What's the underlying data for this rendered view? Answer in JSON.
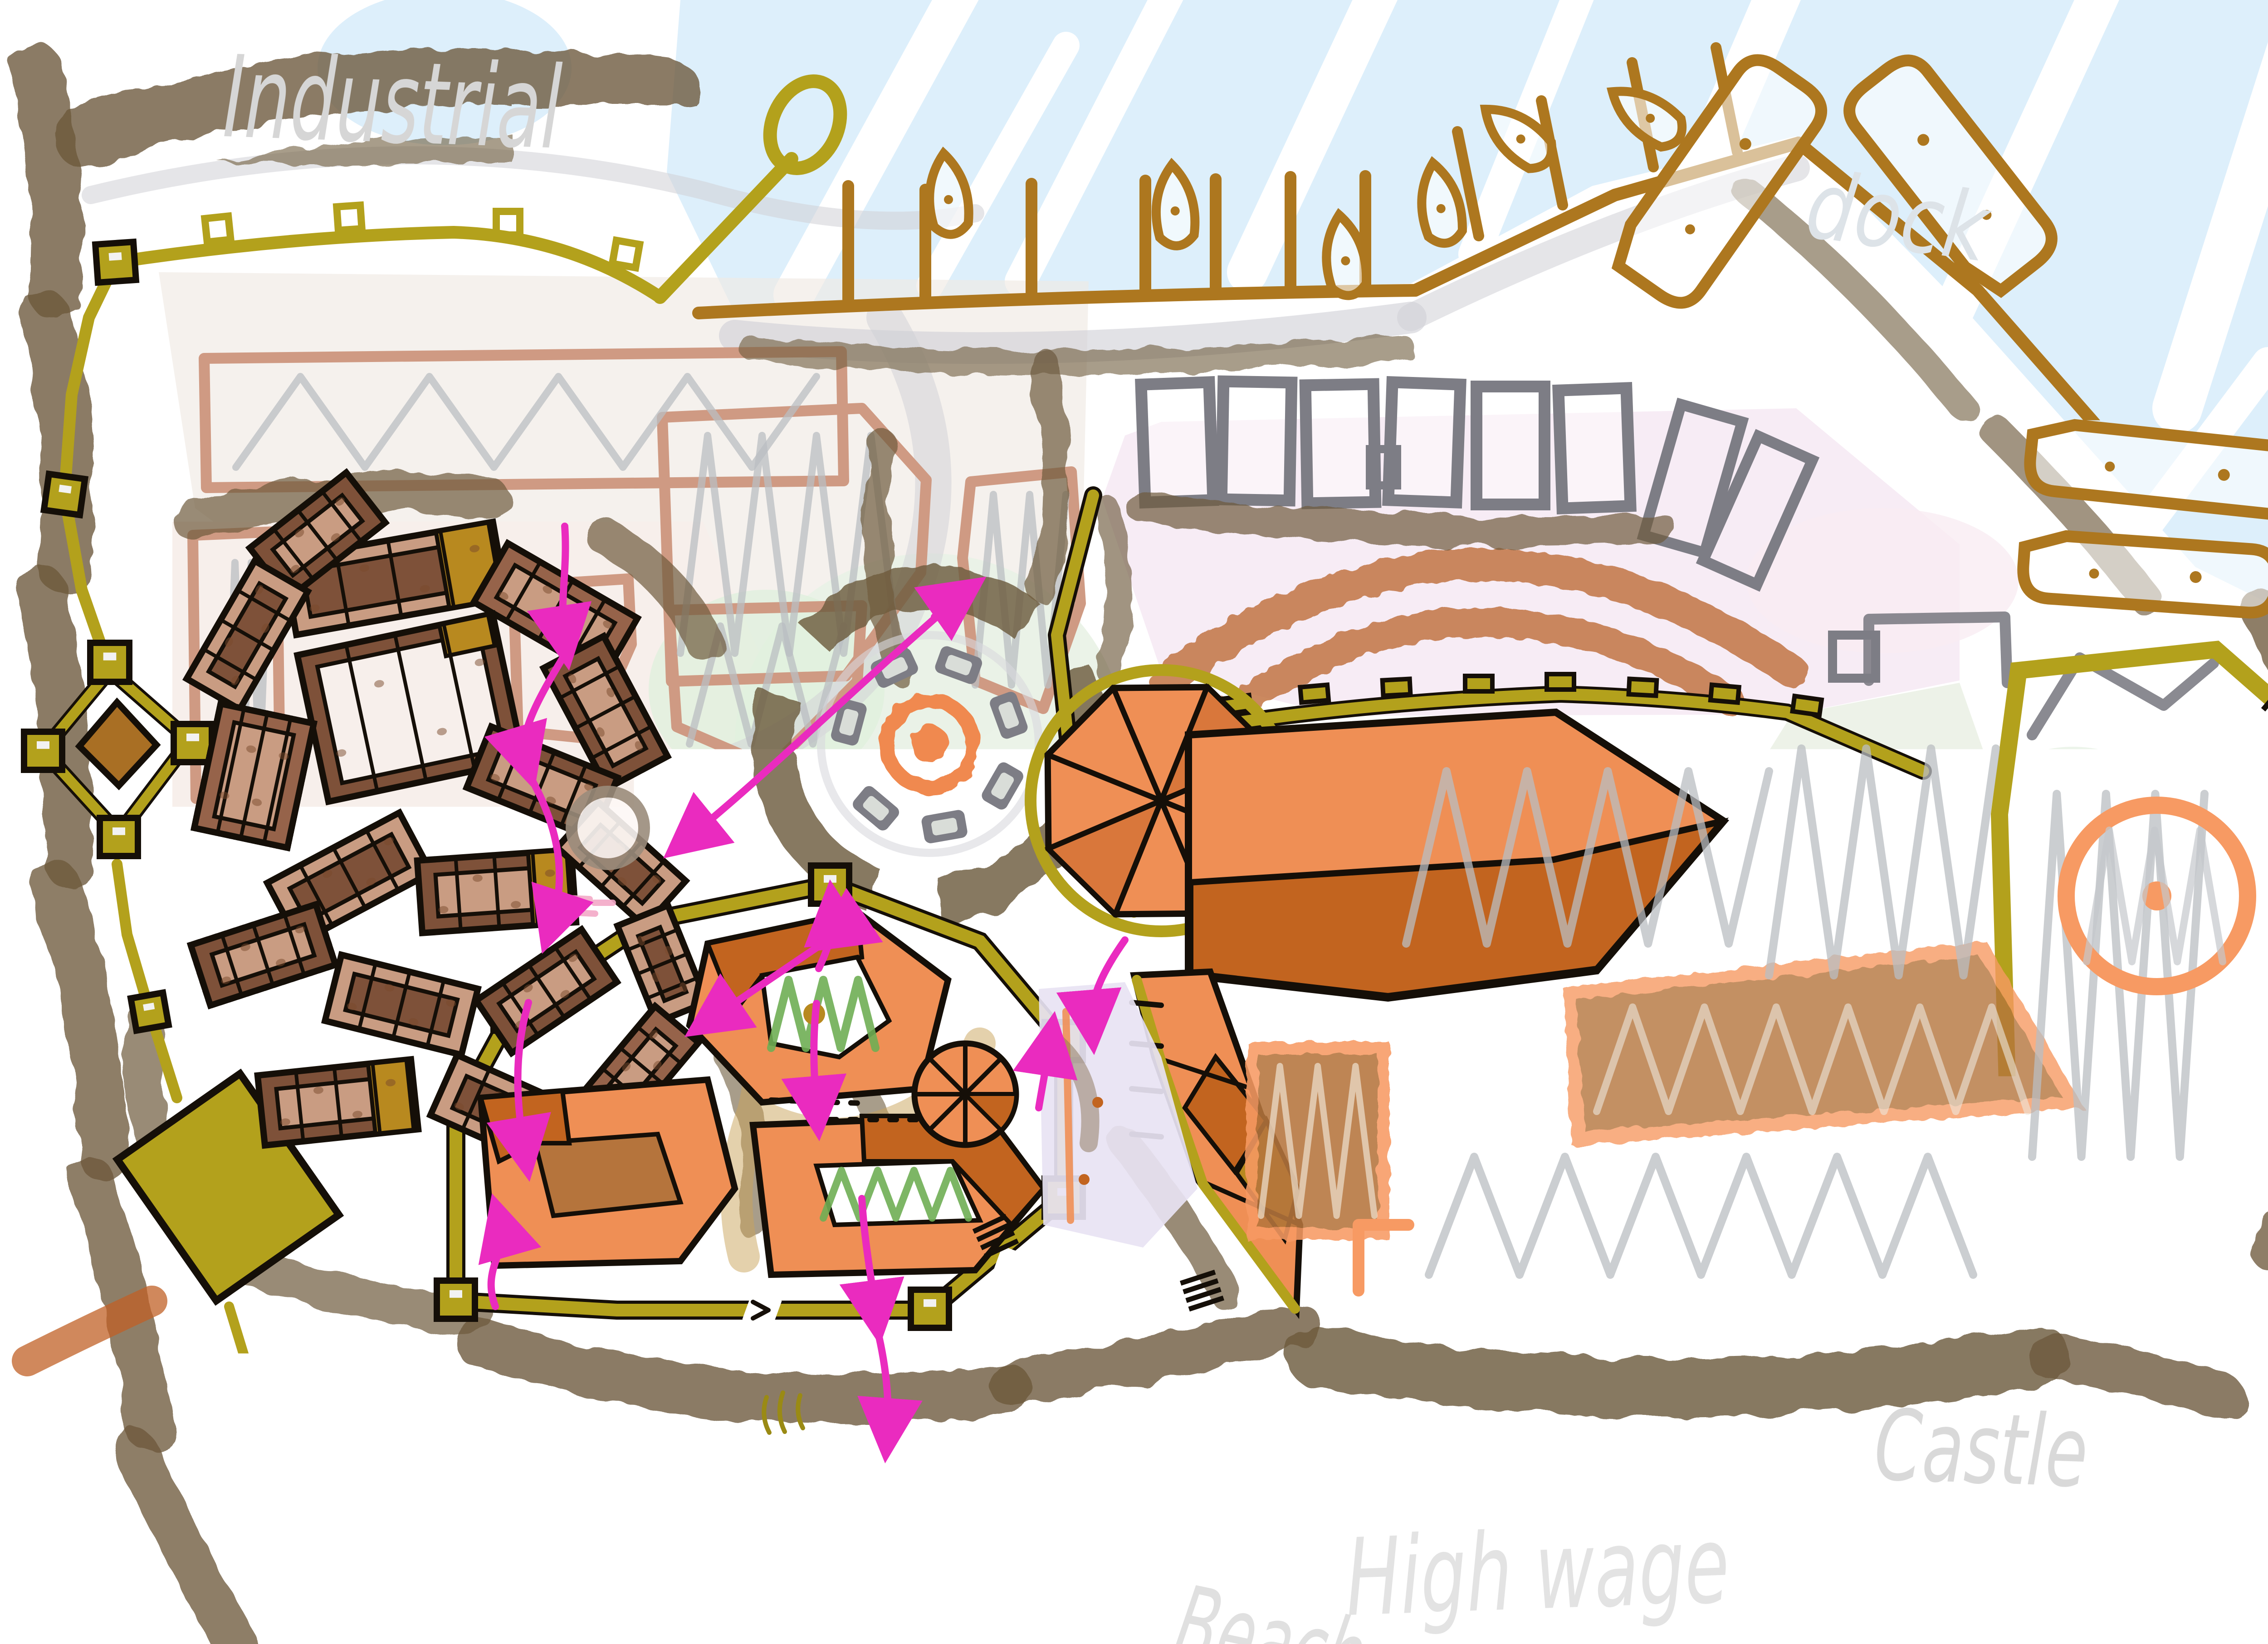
{
  "map_labels": {
    "industrial": {
      "text": "Industrial"
    },
    "dock": {
      "text": "dock"
    },
    "castle": {
      "text": "Castle"
    },
    "high_wage": {
      "text": "High wage"
    },
    "beach": {
      "text": "Beach"
    }
  },
  "palette": {
    "paper": "#ffffff",
    "water": "#ddeffb",
    "water_streak": "#ffffff",
    "sand": "#f6f3d8",
    "scrub": "#6e5a3d",
    "wall_olive": "#b3a11c",
    "dock_brown": "#ad771f",
    "stone_gray": "#7d7d85",
    "old_roof_tan": "#c99c82",
    "old_roof_brown": "#7e5139",
    "old_roof_mid": "#96634a",
    "roof_gold": "#b8891f",
    "new_roof_orange": "#ef8f55",
    "new_roof_dark": "#c2641f",
    "castle_trim_orange": "#f79a63",
    "courtyard_brown": "#b5743c",
    "mint": "#e9f2e6",
    "plaza_green": "#e0f0dd",
    "garden_green": "#6fae54",
    "district_pink": "#f7ecf5",
    "arc_terracotta": "#c06f3e",
    "plot_salmon": "#cf9a83",
    "lavender": "#e8e3f3",
    "street_pink": "#f7efeb",
    "greige": "#efe9e3",
    "route_magenta": "#ea2bbf",
    "handwriting_gray": "#d6d6d6",
    "sketch_gray": "#cfcfd6",
    "outline_black": "#150f08"
  }
}
